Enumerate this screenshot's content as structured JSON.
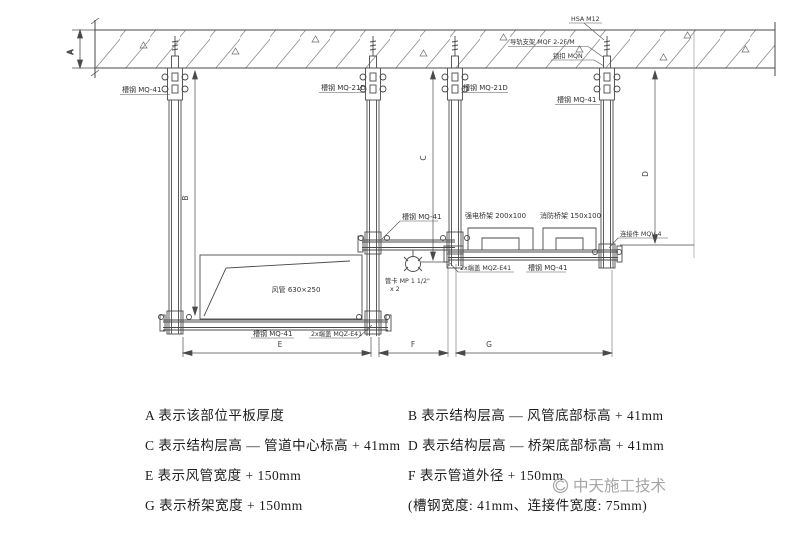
{
  "drawing": {
    "channel_mq41": "槽钢 MQ-41",
    "channel_mq21d": "槽钢 MQ-21D",
    "anchor": "HSA M12",
    "rail_support": "导轨支架 MQF 2-2F/M",
    "lock": "锁扣 MQN",
    "connector": "连接件 MQV-4",
    "endcap": "2x端盖 MQZ-E41",
    "duct": "风管 630×250",
    "tray_strong": "强电桥架 200x100",
    "tray_fire": "消防桥架 150x100",
    "pipe_clamp_line1": "管卡 MP 1 1/2\"",
    "pipe_clamp_line2": "x 2",
    "dims": {
      "A": "A",
      "B": "B",
      "C": "C",
      "D": "D",
      "E": "E",
      "F": "F",
      "G": "G"
    }
  },
  "legend": {
    "left": [
      "A 表示该部位平板厚度",
      "C 表示结构层高 — 管道中心标高 + 41mm",
      "E 表示风管宽度 + 150mm",
      "G 表示桥架宽度 + 150mm"
    ],
    "right": [
      "B 表示结构层高 — 风管底部标高 + 41mm",
      "D 表示结构层高 — 桥架底部标高 + 41mm",
      "F 表示管道外径 + 150mm",
      "(槽钢宽度: 41mm、连接件宽度: 75mm)"
    ]
  },
  "watermark": {
    "text": "中天施工技术"
  },
  "colors": {
    "line": "#4a4a4a",
    "hatch": "#8d8d8d",
    "watermark": "#a6a6a6"
  }
}
